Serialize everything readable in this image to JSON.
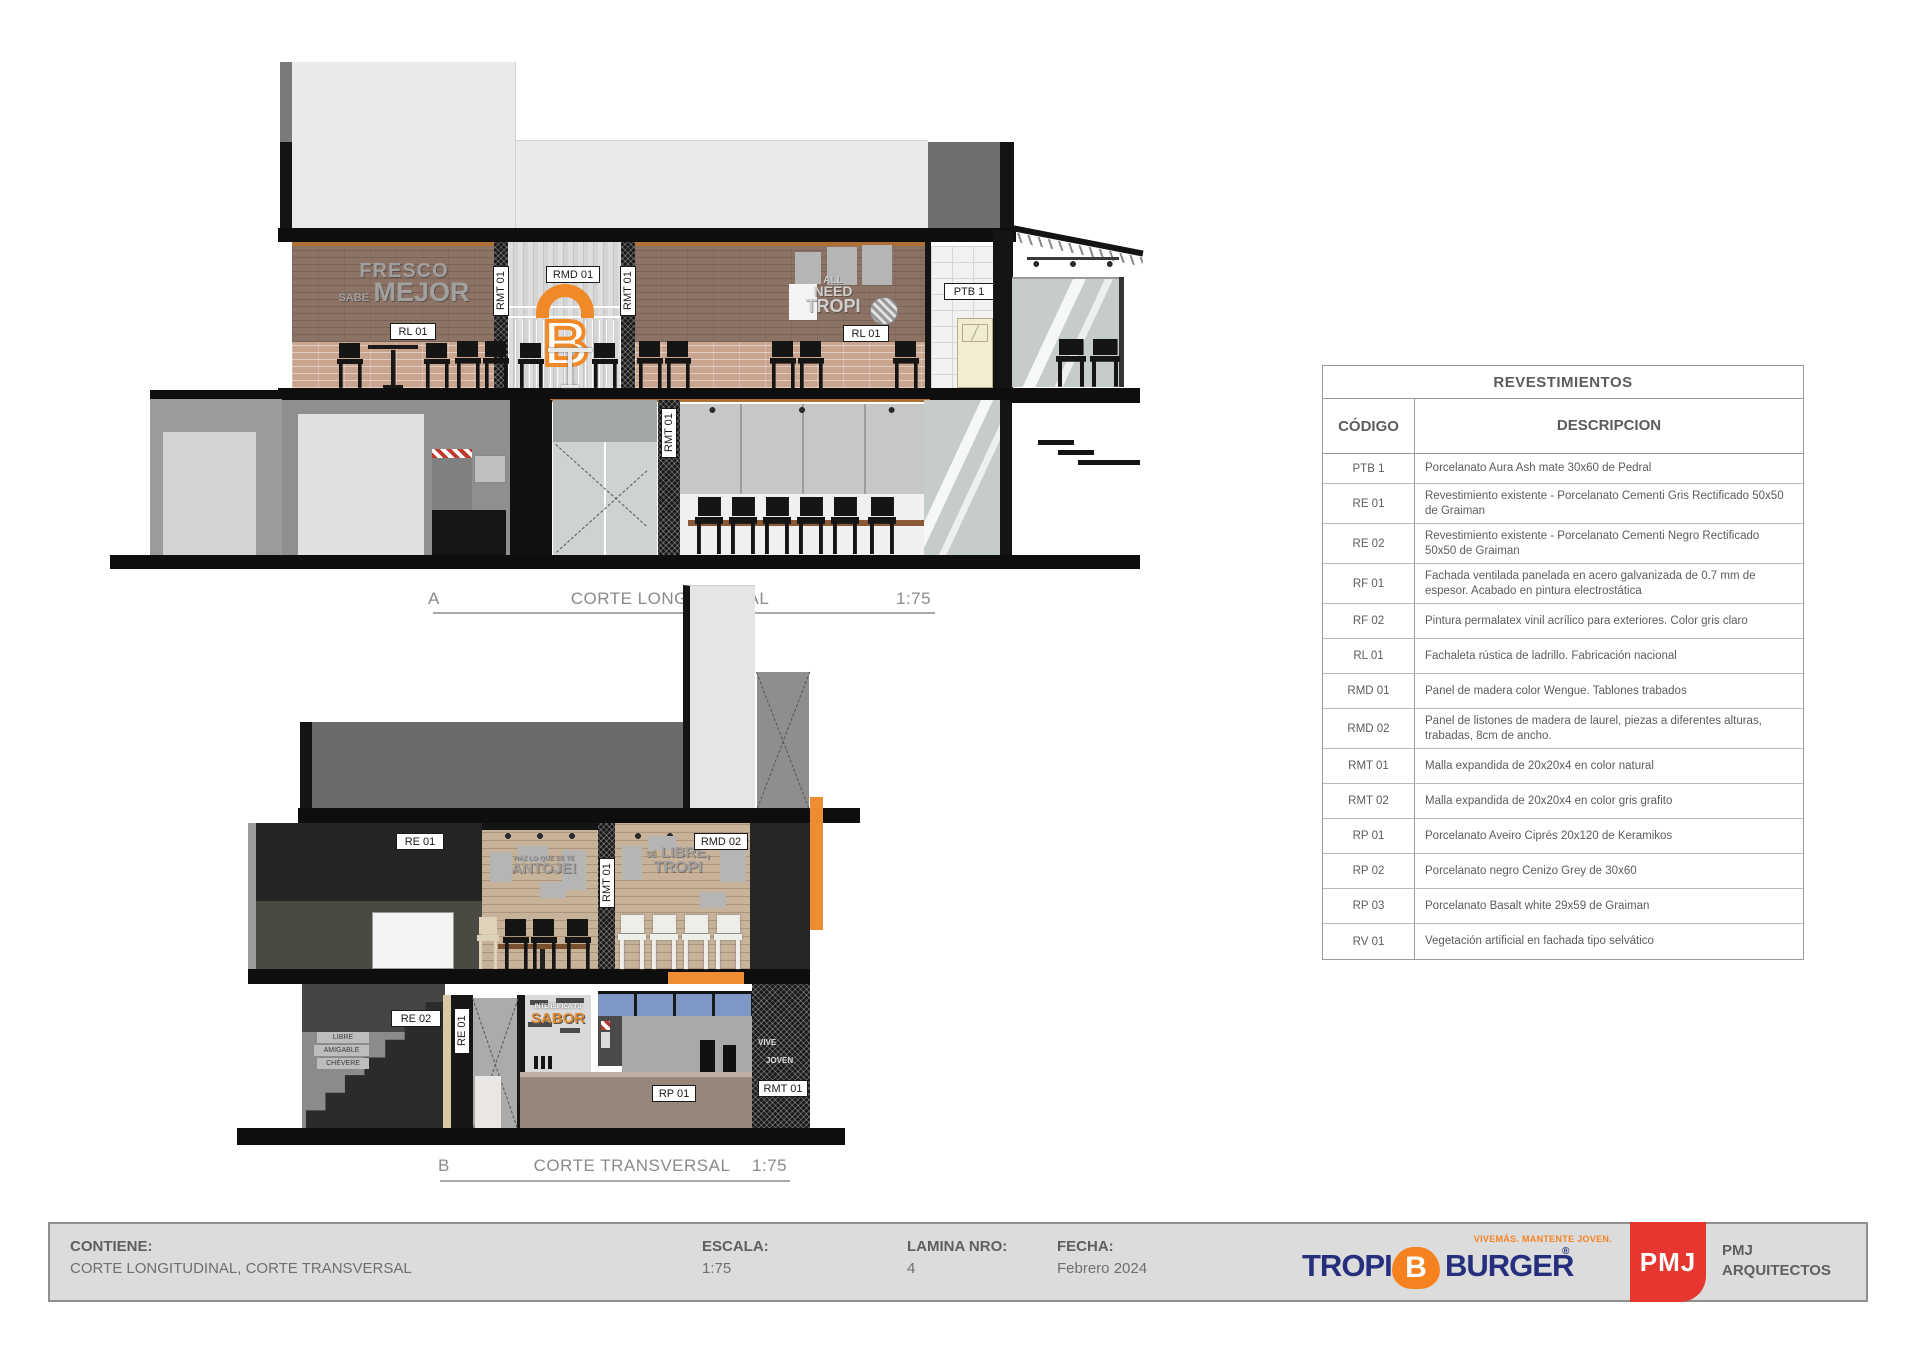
{
  "drawings": {
    "a": {
      "id": "A",
      "title": "CORTE LONGITUDINAL",
      "scale": "1:75",
      "art": {
        "fresco_top": "FRESCO",
        "fresco_small": "SABE",
        "fresco_big": "MEJOR",
        "all": "ALL",
        "need": "NEED",
        "tropi": "TROPI",
        "b_logo": "B"
      }
    },
    "b": {
      "id": "B",
      "title": "CORTE TRANSVERSAL",
      "scale": "1:75",
      "art": {
        "antoje_small": "HAZ LO QUE SE TE",
        "antoje_big": "ANTOJE!",
        "libre_small": "SÉ",
        "libre_big": "LIBRE,",
        "tropi_big": "TROPI",
        "menu_small": "INTENSIFICA TU",
        "menu_big": "SABOR",
        "vive": "VIVE",
        "joven": "JOVEN",
        "sign1": "LIBRE",
        "sign2": "AMIGABLE",
        "sign3": "CHÉVERE"
      }
    }
  },
  "tags": {
    "ptb1": "PTB 1",
    "re01": "RE 01",
    "re02": "RE 02",
    "rl01": "RL 01",
    "rmd01": "RMD 01",
    "rmd02": "RMD 02",
    "rmt01": "RMT 01",
    "rp01": "RP 01"
  },
  "materials_table": {
    "title": "REVESTIMIENTOS",
    "col_code": "CÓDIGO",
    "col_desc": "DESCRIPCION",
    "rows": [
      {
        "code": "PTB 1",
        "desc": "Porcelanato Aura Ash mate 30x60 de Pedral"
      },
      {
        "code": "RE 01",
        "desc": "Revestimiento existente - Porcelanato Cementi Gris Rectificado 50x50 de Graiman"
      },
      {
        "code": "RE 02",
        "desc": "Revestimiento existente - Porcelanato Cementi Negro Rectificado 50x50 de Graiman"
      },
      {
        "code": "RF 01",
        "desc": "Fachada ventilada panelada en acero galvanizada de 0.7 mm de espesor. Acabado en pintura electrostática"
      },
      {
        "code": "RF 02",
        "desc": "Pintura permalatex vinil acrílico para exteriores. Color gris claro"
      },
      {
        "code": "RL 01",
        "desc": "Fachaleta rústica de ladrillo. Fabricación nacional"
      },
      {
        "code": "RMD 01",
        "desc": "Panel de madera color Wengue. Tablones trabados"
      },
      {
        "code": "RMD 02",
        "desc": "Panel de listones de madera de laurel, piezas a diferentes alturas, trabadas, 8cm de ancho."
      },
      {
        "code": "RMT 01",
        "desc": "Malla expandida de 20x20x4 en color natural"
      },
      {
        "code": "RMT 02",
        "desc": "Malla expandida de 20x20x4 en color gris grafito"
      },
      {
        "code": "RP 01",
        "desc": "Porcelanato Aveiro Ciprés 20x120 de Keramikos"
      },
      {
        "code": "RP 02",
        "desc": "Porcelanato negro Cenizo Grey de 30x60"
      },
      {
        "code": "RP 03",
        "desc": "Porcelanato Basalt white 29x59 de Graiman"
      },
      {
        "code": "RV 01",
        "desc": "Vegetación artificial en fachada tipo selvático"
      }
    ]
  },
  "title_block": {
    "contiene_label": "CONTIENE:",
    "contiene_value": "CORTE LONGITUDINAL, CORTE TRANSVERSAL",
    "escala_label": "ESCALA:",
    "escala_value": "1:75",
    "lamina_label": "LAMINA NRO:",
    "lamina_value": "4",
    "fecha_label": "FECHA:",
    "fecha_value": "Febrero 2024",
    "brand": {
      "tagline": "VIVEMÁS. MANTENTE JOVEN.",
      "word1": "TROPI",
      "b": "B",
      "word2": "BURGER",
      "reg": "®"
    },
    "firm": {
      "logo_text": "PMJ",
      "name_line1": "PMJ",
      "name_line2": "ARQUITECTOS"
    }
  },
  "colors": {
    "accent_orange": "#F5821F",
    "brand_navy": "#252F7D",
    "firm_red": "#E73530"
  }
}
